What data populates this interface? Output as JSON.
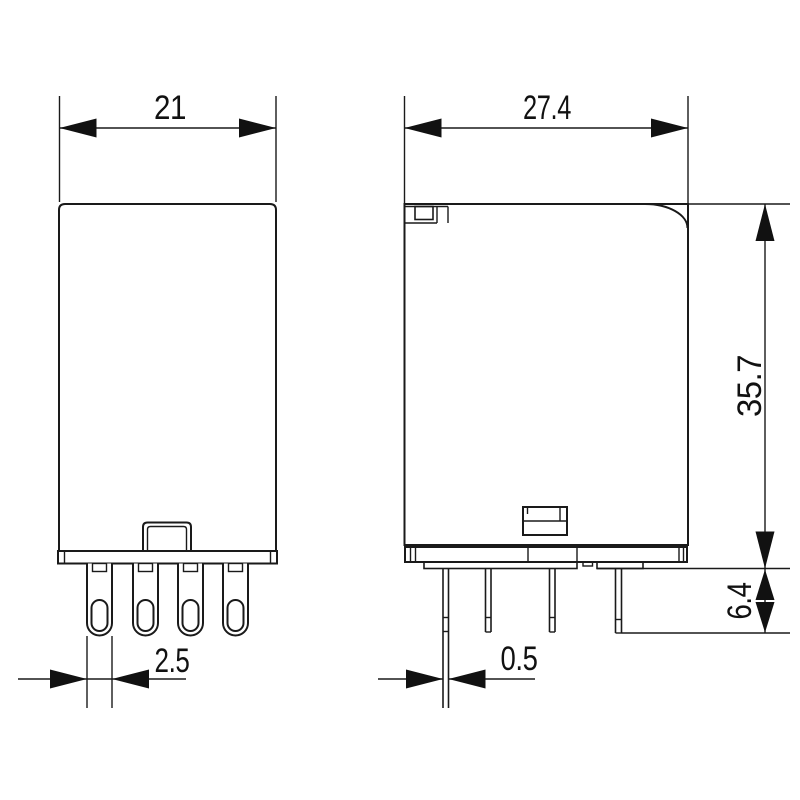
{
  "drawing": {
    "type": "technical-dimension-drawing",
    "subject": "plug-in relay, front and side outline views with pin detail",
    "colors": {
      "line": "#1a1a1a",
      "background": "#ffffff"
    },
    "dimensions": {
      "front_width": "21",
      "side_width": "27.4",
      "body_height": "35.7",
      "pin_length": "6.4",
      "front_pin_width": "2.5",
      "side_pin_thickness": "0.5"
    }
  }
}
